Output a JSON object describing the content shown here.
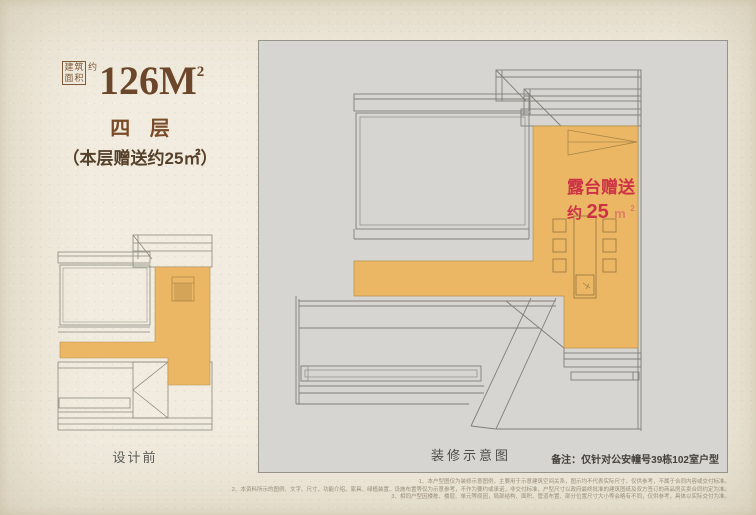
{
  "colors": {
    "accent_orange": "#ecb765",
    "accent_red": "#cd3246",
    "brand_brown": "#6b462a",
    "panel_gray": "#d6d5d1",
    "paper_cream": "#f1ecdf"
  },
  "header": {
    "stamp_chars": [
      "建",
      "筑",
      "面",
      "积"
    ],
    "approx_label": "约",
    "area_value": "126M",
    "area_sup": "2",
    "floor_label": "四 层",
    "gift_note": "（本层赠送约25㎡）"
  },
  "small_plan": {
    "caption": "设计前"
  },
  "large_plan": {
    "terrace_line1": "露台赠送",
    "terrace_line2_yue": "约",
    "terrace_line2_num": "25",
    "terrace_unit": "m",
    "terrace_unit_sup": "2",
    "caption": "装修示意图",
    "note": "备注：仅针对公安幢号39栋102室户型"
  },
  "footer": {
    "disclaimers": [
      "1、本户型图仅为装修示意图例，主要用于示意建筑空间关系，图示均不代表实际尺寸，仅供参考，不属于合同内容或交付标准。",
      "2、本资料所示的图例、文字、尺寸、功能介绍、家具、绿植装置、设施布置等仅为示意参考，不作为要约或承诺，非交付标准，户型尺寸以政府最终批准的建筑图纸及双方签订的商品房买卖合同约定为准。",
      "3、相同户型因楼栋、楼层、单元等原因，局部结构、面积、管道布置、部分位置尺寸大小等会略有不同，仅供参考，具体以实际交付为准。"
    ]
  }
}
